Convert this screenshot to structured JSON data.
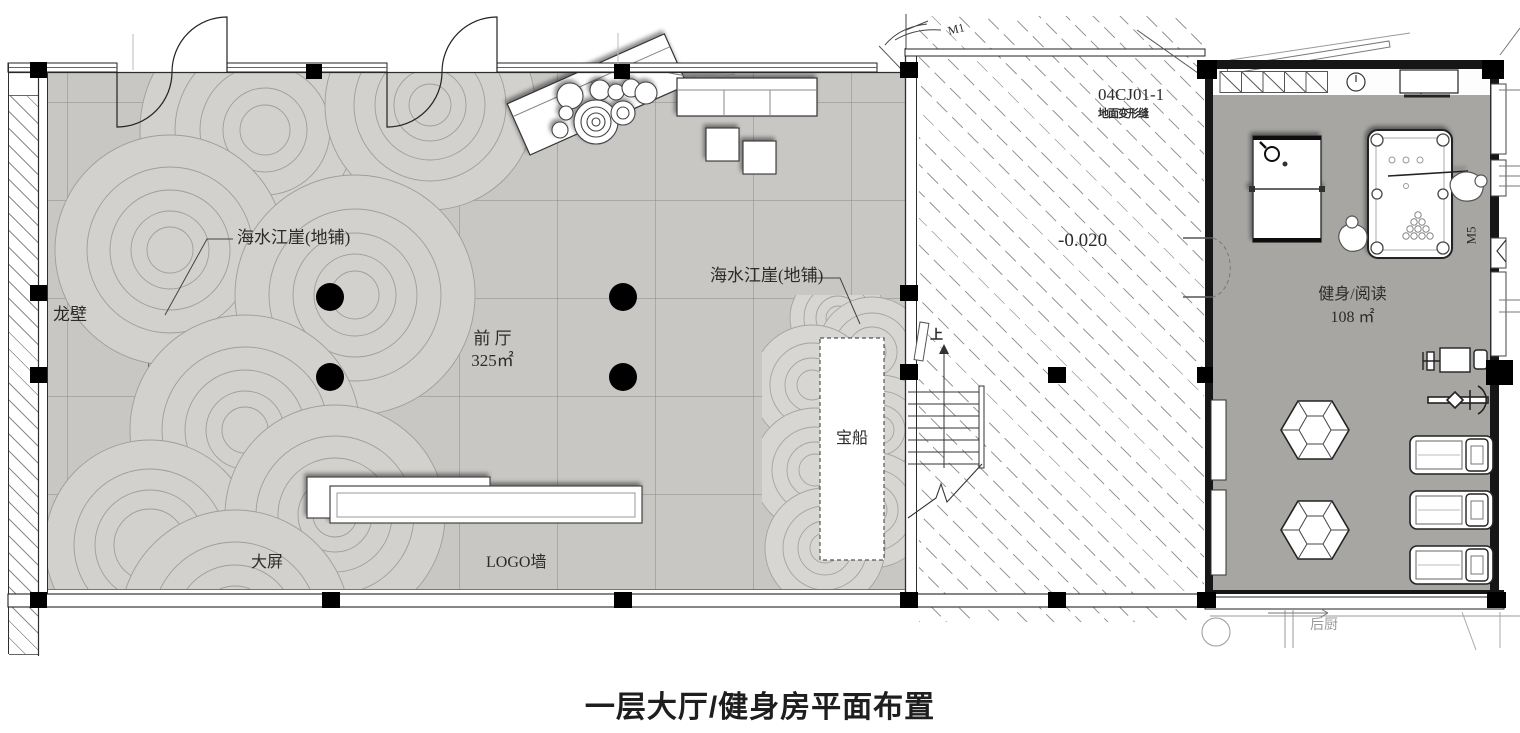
{
  "title": "一层大厅/健身房平面布置",
  "lobby": {
    "name": "前 厅",
    "area": "325㎡",
    "pattern_label_left": "海水江崖(地铺)",
    "pattern_label_right": "海水江崖(地铺)",
    "dragon_wall": "龙壁",
    "treasure_boat": "宝船",
    "big_screen": "大屏",
    "logo_wall": "LOGO墙"
  },
  "corridor": {
    "detail_code": "04CJ01-1",
    "detail_note": "地面变形缝",
    "elevation": "-0.020",
    "stairs_up": "上",
    "door_mark": "M1"
  },
  "gym": {
    "name": "健身/阅读",
    "area": "108 ㎡",
    "door_mark": "M5",
    "kitchen": "后厨"
  },
  "colors": {
    "lobby_floor": "#c9c7c4",
    "gym_floor": "#a7a6a3",
    "wave_fill": "#d3d1cd",
    "line": "#333333"
  }
}
